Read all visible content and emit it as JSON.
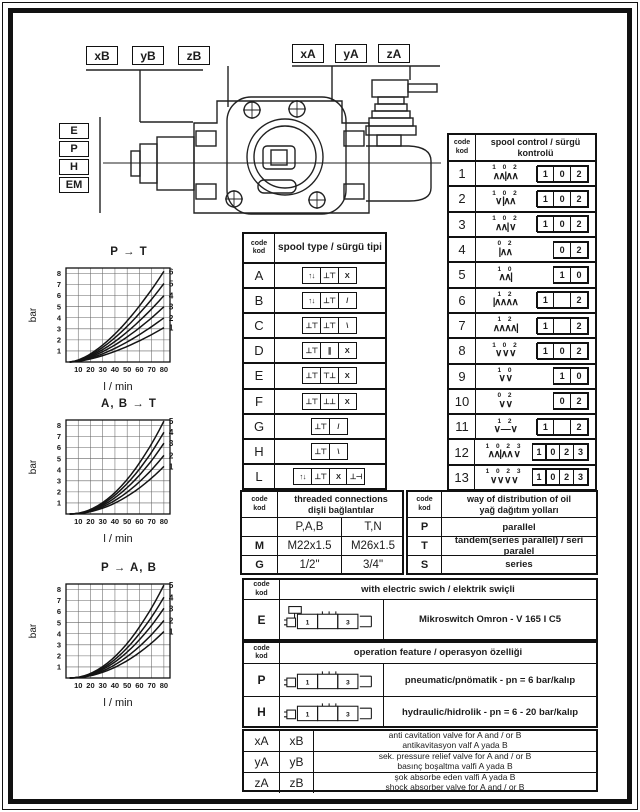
{
  "colors": {
    "paper": "#ffffff",
    "ink": "#1c1c1c"
  },
  "drawing": {
    "port_labels_left": [
      "xB",
      "yB",
      "zB"
    ],
    "port_labels_right": [
      "xA",
      "yA",
      "zA"
    ],
    "actuation_labels": [
      "E",
      "P",
      "H",
      "EM"
    ]
  },
  "chart_data": [
    {
      "type": "line",
      "title": "P → T",
      "ylabel": "bar",
      "xlabel": "l / min",
      "xlim": [
        0,
        85
      ],
      "ylim": [
        0,
        8.5
      ],
      "x_ticks": [
        10,
        20,
        30,
        40,
        50,
        60,
        70,
        80
      ],
      "y_ticks": [
        1,
        2,
        3,
        4,
        5,
        6,
        7,
        8
      ],
      "grid": true,
      "legend_position": "right-of-curve-ends",
      "curve_start_lmin": 3,
      "curve_end_lmin": 80,
      "curve_exponent": 1.6,
      "series": [
        {
          "name": "1",
          "end_bar": 3.1
        },
        {
          "name": "2",
          "end_bar": 4.0
        },
        {
          "name": "3",
          "end_bar": 5.0
        },
        {
          "name": "4",
          "end_bar": 6.0
        },
        {
          "name": "5",
          "end_bar": 7.1
        },
        {
          "name": "6",
          "end_bar": 8.2
        }
      ]
    },
    {
      "type": "line",
      "title": "A, B → T",
      "ylabel": "bar",
      "xlabel": "l / min",
      "xlim": [
        0,
        85
      ],
      "ylim": [
        0,
        8.5
      ],
      "x_ticks": [
        10,
        20,
        30,
        40,
        50,
        60,
        70,
        80
      ],
      "y_ticks": [
        1,
        2,
        3,
        4,
        5,
        6,
        7,
        8
      ],
      "grid": true,
      "legend_position": "right-of-curve-ends",
      "curve_start_lmin": 3,
      "curve_end_lmin": 80,
      "curve_exponent": 2.0,
      "series": [
        {
          "name": "1",
          "end_bar": 4.3
        },
        {
          "name": "2",
          "end_bar": 5.3
        },
        {
          "name": "3",
          "end_bar": 6.4
        },
        {
          "name": "4",
          "end_bar": 7.4
        },
        {
          "name": "5",
          "end_bar": 8.4
        }
      ]
    },
    {
      "type": "line",
      "title": "P → A, B",
      "ylabel": "bar",
      "xlabel": "l / min",
      "xlim": [
        0,
        85
      ],
      "ylim": [
        0,
        8.5
      ],
      "x_ticks": [
        10,
        20,
        30,
        40,
        50,
        60,
        70,
        80
      ],
      "y_ticks": [
        1,
        2,
        3,
        4,
        5,
        6,
        7,
        8
      ],
      "grid": true,
      "legend_position": "right-of-curve-ends",
      "curve_start_lmin": 3,
      "curve_end_lmin": 80,
      "curve_exponent": 2.0,
      "series": [
        {
          "name": "1",
          "end_bar": 4.2
        },
        {
          "name": "2",
          "end_bar": 5.2
        },
        {
          "name": "3",
          "end_bar": 6.3
        },
        {
          "name": "4",
          "end_bar": 7.3
        },
        {
          "name": "5",
          "end_bar": 8.4
        }
      ]
    }
  ],
  "spool_type_table": {
    "header_code": "code\nkod",
    "title": "spool type / sürgü tipi",
    "rows": [
      {
        "code": "A",
        "cells": [
          "↑↓",
          "⊥⊤",
          "X"
        ]
      },
      {
        "code": "B",
        "cells": [
          "↑↓",
          "⊥⊤",
          "/"
        ]
      },
      {
        "code": "C",
        "cells": [
          "⊥⊤",
          "⊥⊤",
          "\\"
        ]
      },
      {
        "code": "D",
        "cells": [
          "⊥⊤",
          "∥",
          "X"
        ]
      },
      {
        "code": "E",
        "cells": [
          "⊥⊤",
          "⊤⊥",
          "X"
        ]
      },
      {
        "code": "F",
        "cells": [
          "⊥⊤",
          "⊥⊥",
          "X"
        ]
      },
      {
        "code": "G",
        "cells": [
          "⊥⊤",
          "/"
        ]
      },
      {
        "code": "H",
        "cells": [
          "⊥⊤",
          "\\"
        ]
      },
      {
        "code": "L",
        "cells": [
          "↑↓",
          "⊥⊤",
          "X",
          "⊥⊣"
        ]
      }
    ]
  },
  "spool_control_table": {
    "header_code": "code\nkod",
    "title": "spool control / sürgü kontrolü",
    "rows": [
      {
        "code": "1",
        "nums": "1 0 2",
        "symbol": "∧∧|∧∧",
        "positions": [
          "1",
          "0",
          "2"
        ]
      },
      {
        "code": "2",
        "nums": "1 0 2",
        "symbol": "∨ |∧∧",
        "positions": [
          "1",
          "0",
          "2"
        ]
      },
      {
        "code": "3",
        "nums": "1 0 2",
        "symbol": "∧∧| ∨",
        "positions": [
          "1",
          "0",
          "2"
        ]
      },
      {
        "code": "4",
        "nums": "0 2",
        "symbol": "|∧∧",
        "positions": [
          "0",
          "2"
        ]
      },
      {
        "code": "5",
        "nums": "1 0",
        "symbol": "∧∧|",
        "positions": [
          "1",
          "0"
        ]
      },
      {
        "code": "6",
        "nums": "1   2",
        "symbol": "|∧∧∧∧",
        "positions": [
          "1",
          "",
          "2"
        ]
      },
      {
        "code": "7",
        "nums": "1   2",
        "symbol": "∧∧∧∧|",
        "positions": [
          "1",
          "",
          "2"
        ]
      },
      {
        "code": "8",
        "nums": "1 0 2",
        "symbol": "∨ ∨ ∨",
        "positions": [
          "1",
          "0",
          "2"
        ]
      },
      {
        "code": "9",
        "nums": "1 0",
        "symbol": "∨ ∨",
        "positions": [
          "1",
          "0"
        ]
      },
      {
        "code": "10",
        "nums": "0 2",
        "symbol": "∨ ∨",
        "positions": [
          "0",
          "2"
        ]
      },
      {
        "code": "11",
        "nums": "1  2",
        "symbol": "∨ — ∨",
        "positions": [
          "1",
          "",
          "2"
        ]
      },
      {
        "code": "12",
        "nums": "1 0 2 3",
        "symbol": "∧∧|∧∧ ∨",
        "positions": [
          "1",
          "0",
          "2",
          "3"
        ]
      },
      {
        "code": "13",
        "nums": "1 0 2 3",
        "symbol": "∨ ∨ ∨ ∨",
        "positions": [
          "1",
          "0",
          "2",
          "3"
        ]
      }
    ]
  },
  "threaded_table": {
    "header_code": "code\nkod",
    "title": "threaded connections\ndişli bağlantılar",
    "rows": [
      [
        "",
        "P,A,B",
        "T,N"
      ],
      [
        "M",
        "M22x1.5",
        "M26x1.5"
      ],
      [
        "G",
        "1/2\"",
        "3/4\""
      ]
    ]
  },
  "distribution_table": {
    "header_code": "code\nkod",
    "title": "way of distribution of oil\nyağ dağıtım yolları",
    "rows": [
      [
        "P",
        "parallel"
      ],
      [
        "T",
        "tandem(series parallel) / seri paralel"
      ],
      [
        "S",
        "series"
      ]
    ]
  },
  "electric_table": {
    "header_code": "code\nkod",
    "title": "with electric swich / elektrik swiçli",
    "row": {
      "code": "E",
      "icon_cells": [
        "1",
        "",
        "3"
      ],
      "text": "Mikroswitch Omron - V 165 I C5"
    }
  },
  "operation_table": {
    "header_code": "code\nkod",
    "title": "operation feature / operasyon özelliği",
    "rows": [
      {
        "code": "P",
        "icon_cells": [
          "1",
          "",
          "3"
        ],
        "text": "pneumatic/pnömatik - pn = 6 bar/kalıp"
      },
      {
        "code": "H",
        "icon_cells": [
          "1",
          "",
          "3"
        ],
        "text": "hydraulic/hidrolik - pn = 6 - 20 bar/kalıp"
      }
    ]
  },
  "options_table": {
    "rows": [
      {
        "a": "xA",
        "b": "xB",
        "desc": "anti cavitation valve for A and / or B\nantikavitasyon valf A yada B"
      },
      {
        "a": "yA",
        "b": "yB",
        "desc": "sek. pressure relief valve for A and / or B\nbasınç boşaltma valfi A yada B"
      },
      {
        "a": "zA",
        "b": "zB",
        "desc": "şok absorbe eden valfi A yada B\nshock absorber valve for A and / or B"
      }
    ]
  }
}
